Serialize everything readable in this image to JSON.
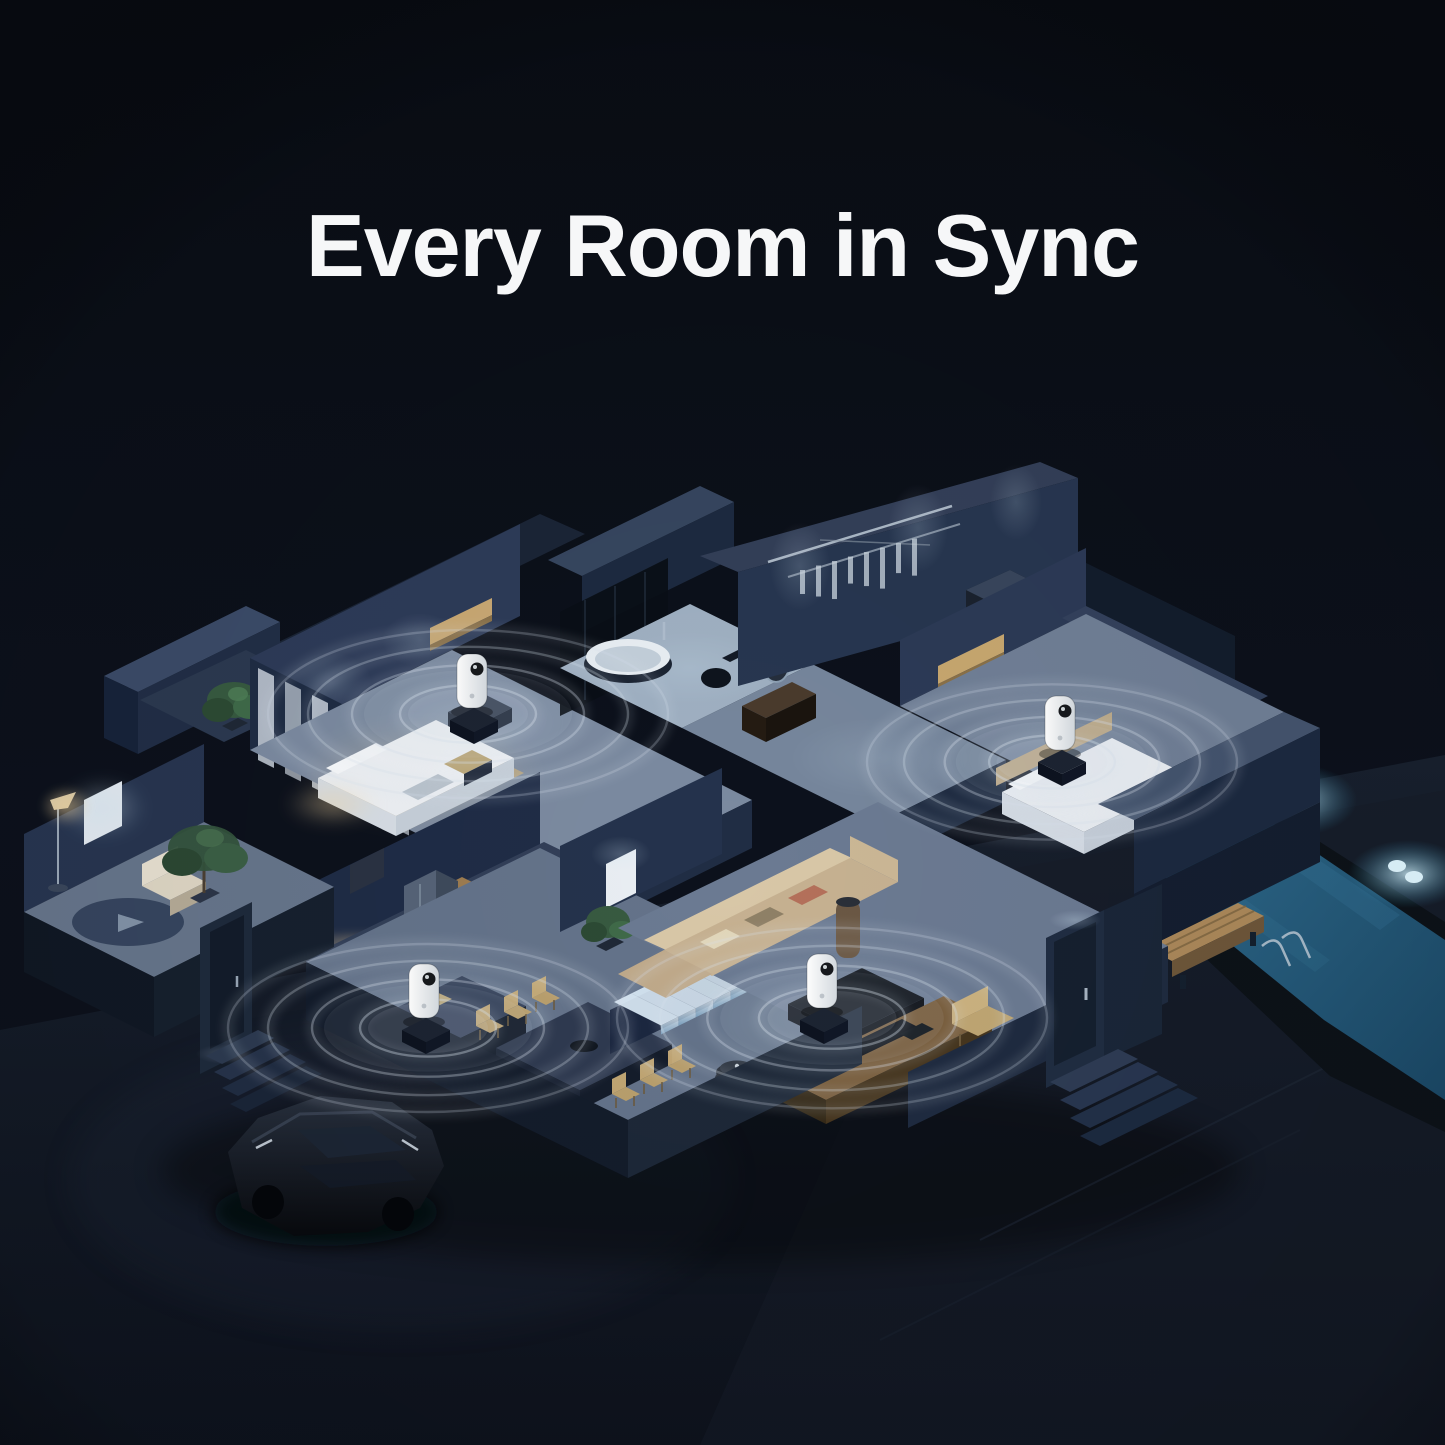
{
  "headline": {
    "text": "Every Room in Sync",
    "color": "#f6f7f8"
  },
  "scene": {
    "description": "Isometric night-time cutaway of a two-story smart home; four white smart devices, one per room, emit synchronized ripple waves; pool, parked car and lit staircase visible",
    "background_color": "#0b0f18",
    "colors": {
      "ripple": "#d8e2ec",
      "device_body": "#f4f6f7",
      "device_lens": "#17191d",
      "pool_water": "#265b7d",
      "pool_glow": "#cfeffb",
      "stair_glow": "#dcebf7",
      "warm_light": "#f3d6a0"
    },
    "devices": [
      {
        "id": "upper-bedroom-device",
        "room": "upper bedroom",
        "x": 472,
        "y": 680,
        "ripple_cx": 468,
        "ripple_cy": 714,
        "max_rx": 200
      },
      {
        "id": "right-bedroom-device",
        "room": "right bedroom",
        "x": 1060,
        "y": 722,
        "ripple_cx": 1052,
        "ripple_cy": 762,
        "max_rx": 185
      },
      {
        "id": "living-room-device",
        "room": "living room",
        "x": 822,
        "y": 980,
        "ripple_cx": 832,
        "ripple_cy": 1018,
        "max_rx": 215
      },
      {
        "id": "kitchen-device",
        "room": "kitchen",
        "x": 424,
        "y": 990,
        "ripple_cx": 428,
        "ripple_cy": 1028,
        "max_rx": 200
      }
    ],
    "ripple_ratios": [
      0.34,
      0.58,
      0.8,
      1.0
    ],
    "ripple_ry_ratio": 0.42
  }
}
